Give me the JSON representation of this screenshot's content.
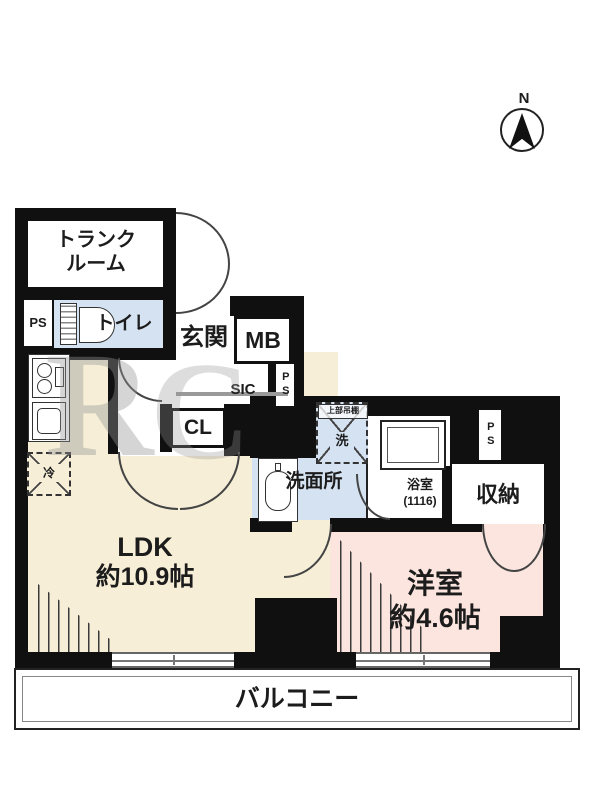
{
  "compass": {
    "north_label": "N"
  },
  "watermark": {
    "letter1": "R",
    "letter2": "C"
  },
  "labels": {
    "trunk_room_line1": "トランク",
    "trunk_room_line2": "ルーム",
    "ps": "PS",
    "toilet": "トイレ",
    "entrance": "玄関",
    "meter_box": "MB",
    "shoes_closet": "SIC",
    "closet": "CL",
    "fridge": "冷",
    "washer": "洗",
    "washer_shelf": "上部吊棚",
    "washroom": "洗面所",
    "bathroom_line1": "浴室",
    "bathroom_line2": "(1116)",
    "storage": "収納",
    "ldk_line1": "LDK",
    "ldk_line2": "約10.9帖",
    "western_room_line1": "洋室",
    "western_room_line2": "約4.6帖",
    "balcony": "バルコニー"
  },
  "colors": {
    "ldk": "#f6eed6",
    "western_room": "#fbe5de",
    "wet_area": "#d4e2f1",
    "wall": "#111111",
    "balcony": "#ffffff"
  }
}
